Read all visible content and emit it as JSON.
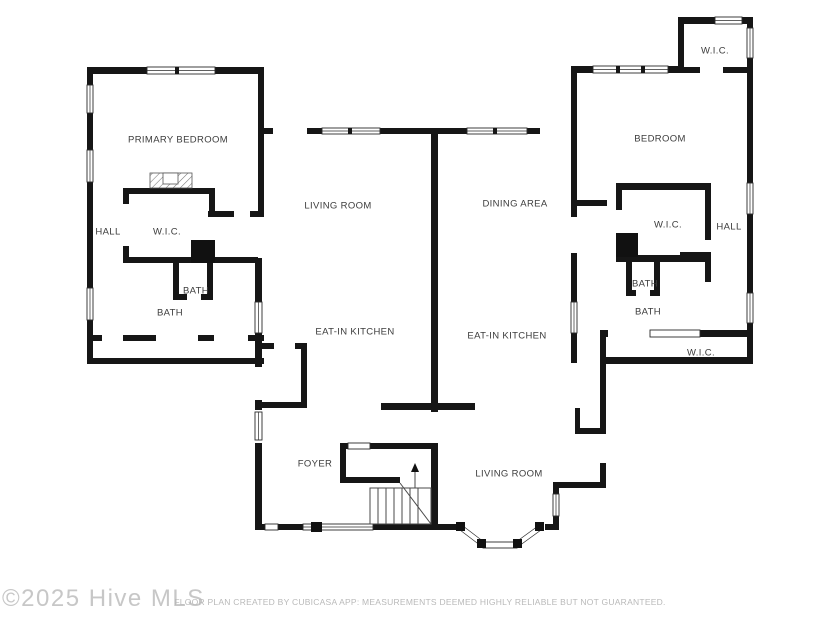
{
  "plan": {
    "rooms": [
      {
        "label": "PRIMARY BEDROOM",
        "x": 178,
        "y": 140
      },
      {
        "label": "HALL",
        "x": 108,
        "y": 232
      },
      {
        "label": "W.I.C.",
        "x": 167,
        "y": 232
      },
      {
        "label": "BATH",
        "x": 196,
        "y": 291
      },
      {
        "label": "BATH",
        "x": 170,
        "y": 313
      },
      {
        "label": "LIVING ROOM",
        "x": 338,
        "y": 206
      },
      {
        "label": "DINING AREA",
        "x": 515,
        "y": 204
      },
      {
        "label": "EAT-IN KITCHEN",
        "x": 355,
        "y": 332
      },
      {
        "label": "EAT-IN KITCHEN",
        "x": 507,
        "y": 336
      },
      {
        "label": "FOYER",
        "x": 315,
        "y": 464
      },
      {
        "label": "LIVING ROOM",
        "x": 509,
        "y": 474
      },
      {
        "label": "BEDROOM",
        "x": 660,
        "y": 139
      },
      {
        "label": "W.I.C.",
        "x": 715,
        "y": 51
      },
      {
        "label": "W.I.C.",
        "x": 668,
        "y": 225
      },
      {
        "label": "HALL",
        "x": 729,
        "y": 227
      },
      {
        "label": "BATH",
        "x": 645,
        "y": 284
      },
      {
        "label": "BATH",
        "x": 648,
        "y": 312
      },
      {
        "label": "W.I.C.",
        "x": 701,
        "y": 353
      }
    ],
    "watermark": "©2025 Hive MLS",
    "disclaimer": "FLOOR PLAN CREATED BY CUBICASA APP: MEASUREMENTS DEEMED HIGHLY RELIABLE BUT NOT GUARANTEED.",
    "colors": {
      "wall": "#161616",
      "label_text": "#3c3c3c",
      "watermark_text": "#c7c7c7",
      "disclaimer_text": "#b9b9b9",
      "background": "#ffffff"
    }
  }
}
